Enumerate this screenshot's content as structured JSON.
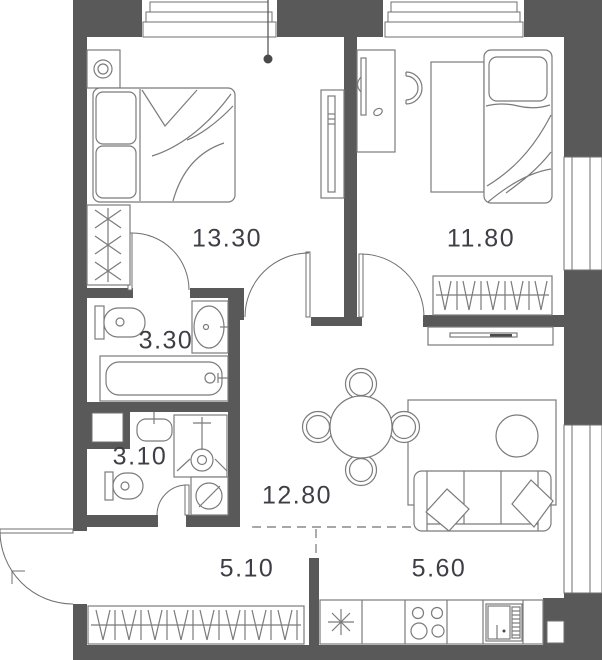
{
  "plan": {
    "type": "apartment-floor-plan",
    "rooms": [
      {
        "id": "bedroom-1",
        "area": "13.30"
      },
      {
        "id": "bedroom-2",
        "area": "11.80"
      },
      {
        "id": "bathroom",
        "area": "3.30"
      },
      {
        "id": "toilet-room",
        "area": "3.10"
      },
      {
        "id": "living-room",
        "area": "12.80"
      },
      {
        "id": "hallway",
        "area": "5.10"
      },
      {
        "id": "kitchen",
        "area": "5.60"
      }
    ],
    "colors": {
      "wall": "#595959",
      "furniture_line": "#7b7b7b",
      "label_text": "#3e3e46",
      "background": "#ffffff"
    },
    "icons": [
      "double-bed-icon",
      "single-bed-icon",
      "nightstand-lamp-icon",
      "wardrobe-hangers-icon",
      "desk-icon",
      "desk-chair-icon",
      "toilet-icon",
      "sink-icon",
      "bathtub-icon",
      "shower-icon",
      "washing-machine-icon",
      "dining-table-icon",
      "dining-chair-icon",
      "sofa-icon",
      "coffee-table-icon",
      "tv-console-icon",
      "kitchen-sink-icon",
      "stove-icon",
      "fridge-icon",
      "entrance-door-icon",
      "door-swing-icon",
      "window-icon",
      "pendant-light-icon"
    ]
  }
}
